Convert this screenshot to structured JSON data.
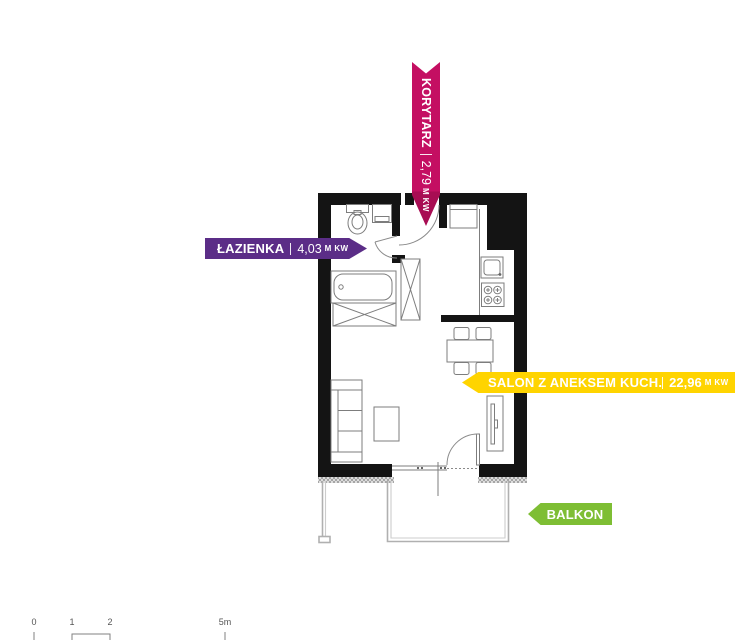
{
  "labels": {
    "korytarz": {
      "name": "KORYTARZ",
      "area": "2,79",
      "unit": "M KW",
      "color": "#c40f62"
    },
    "lazienka": {
      "name": "ŁAZIENKA",
      "area": "4,03",
      "unit": "M KW",
      "color": "#5b2d87"
    },
    "salon": {
      "name": "SALON Z ANEKSEM KUCH.",
      "area": "22,96",
      "unit": "M KW",
      "color": "#ffd400"
    },
    "balkon": {
      "name": "BALKON",
      "color": "#7ebe34"
    }
  },
  "scale_bar": {
    "ticks": [
      "0",
      "1",
      "2",
      "5m"
    ]
  },
  "plan_symbols": [
    "toilet",
    "washbasin-cabinet",
    "bathtub",
    "wardrobe",
    "tall-wardrobe",
    "fridge",
    "kitchen-counter",
    "kitchen-sink",
    "stove",
    "dining-table",
    "chair",
    "sofa",
    "coffee-table",
    "tv-stand",
    "entrance-door",
    "bathroom-door",
    "balcony-door",
    "window",
    "balcony-railing",
    "wall-hatching"
  ]
}
